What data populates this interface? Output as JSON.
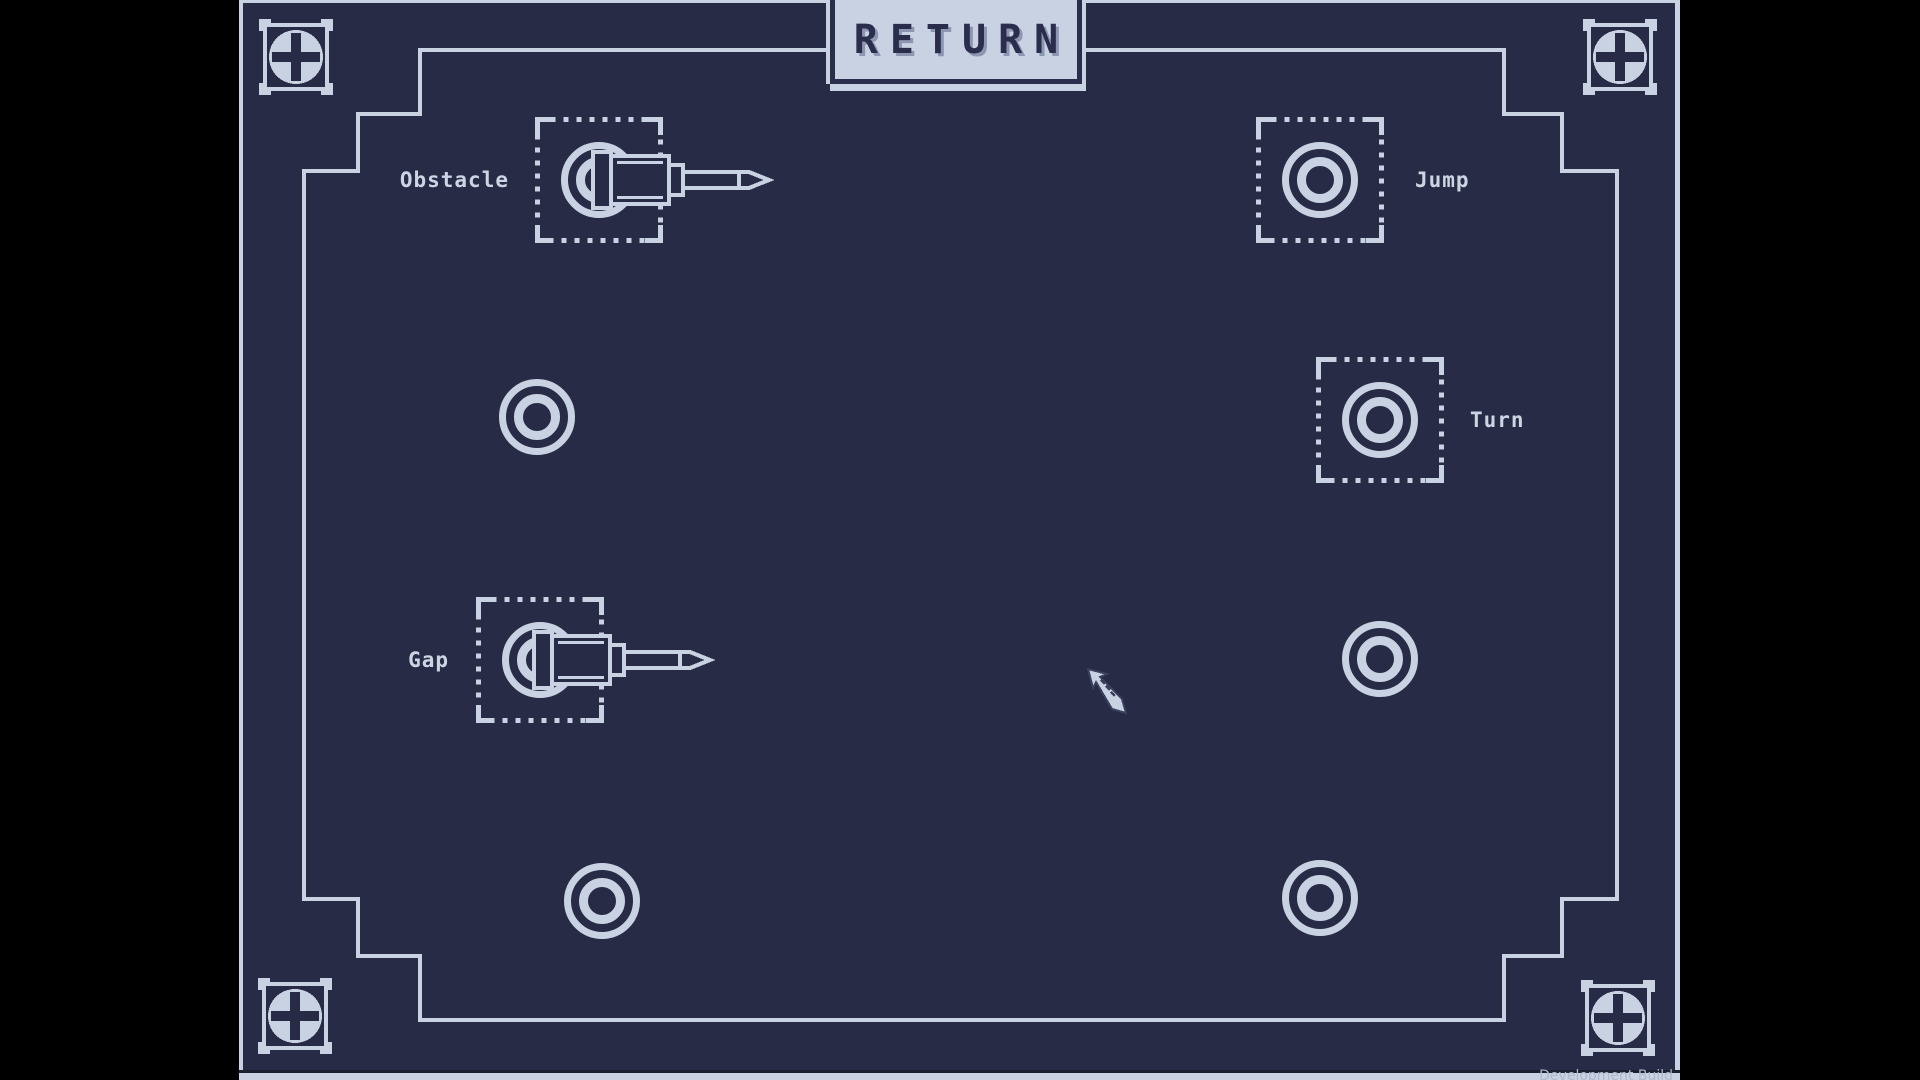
{
  "window": {
    "watermark": "Development Build"
  },
  "header": {
    "return_button": "RETURN"
  },
  "sockets": [
    {
      "id": "obstacle",
      "label": "Obstacle",
      "state": "plugged",
      "boxed": true
    },
    {
      "id": "jump",
      "label": "Jump",
      "state": "empty",
      "boxed": true
    },
    {
      "id": "middle-left",
      "label": "",
      "state": "empty",
      "boxed": false
    },
    {
      "id": "turn",
      "label": "Turn",
      "state": "empty",
      "boxed": true
    },
    {
      "id": "gap",
      "label": "Gap",
      "state": "plugged",
      "boxed": true
    },
    {
      "id": "middle-right",
      "label": "",
      "state": "empty",
      "boxed": false
    },
    {
      "id": "bottom-left",
      "label": "",
      "state": "empty",
      "boxed": false
    },
    {
      "id": "bottom-right",
      "label": "",
      "state": "empty",
      "boxed": false
    }
  ],
  "icons": {
    "screw": "phillips-screw-icon",
    "plug": "cable-plug-icon",
    "cursor": "cursor-arrow-icon"
  },
  "colors": {
    "letterbox": "#000000",
    "panel": "#272b45",
    "line": "#c8d2e2",
    "tab_text": "#2a2e4c",
    "tab_text_shadow": "#8d96b0",
    "watermark_text": "#b0b9cc"
  }
}
